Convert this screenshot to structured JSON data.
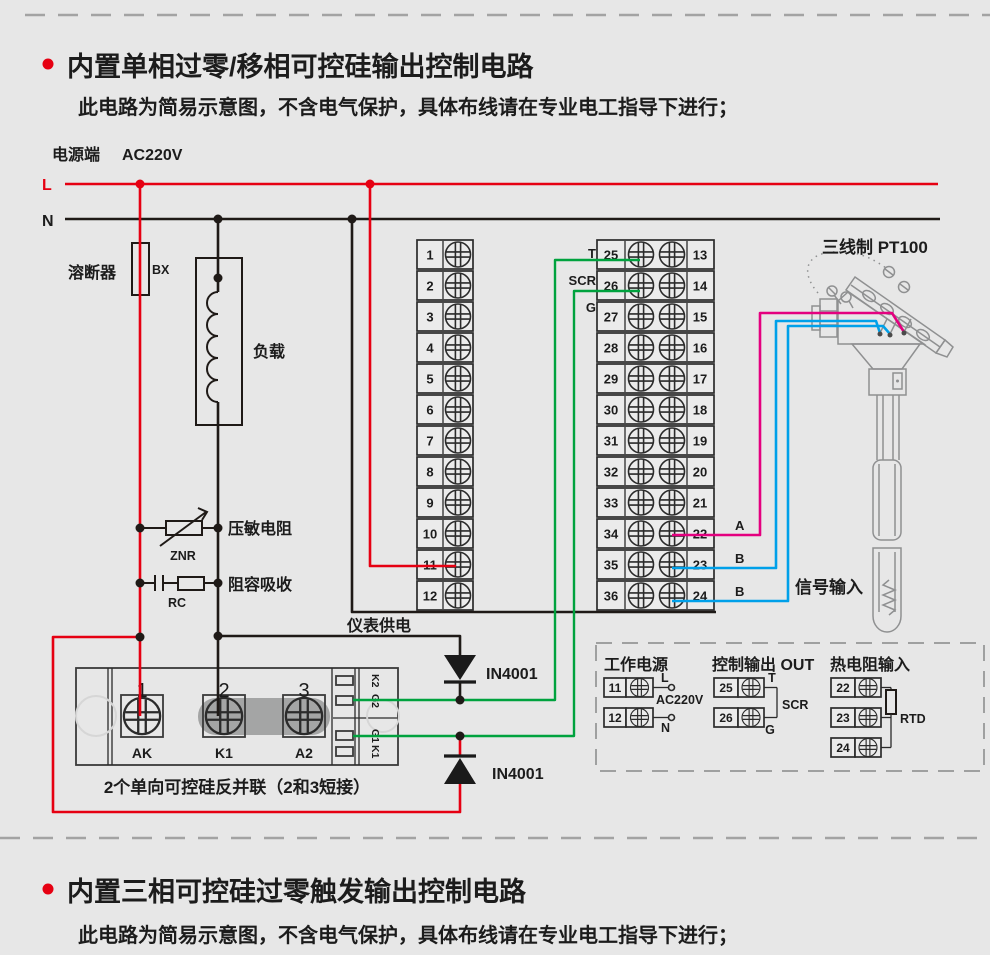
{
  "colors": {
    "red": "#e60012",
    "black": "#1f1a17",
    "green": "#00a23e",
    "magenta": "#e4007f",
    "blue": "#00a0e9",
    "gray": "#8f9091",
    "bg": "#e7e7e7"
  },
  "sections": {
    "one": {
      "title": "内置单相过零/移相可控硅输出控制电路",
      "subtitle": "此电路为简易示意图，不含电气保护，具体布线请在专业电工指导下进行；"
    },
    "two": {
      "title": "内置三相可控硅过零触发输出控制电路",
      "subtitle": "此电路为简易示意图，不含电气保护，具体布线请在专业电工指导下进行；"
    }
  },
  "power": {
    "label": "电源端",
    "voltage": "AC220V",
    "line_l": "L",
    "line_n": "N"
  },
  "components": {
    "fuse": "溶断器",
    "fuse_code": "BX",
    "load": "负载",
    "varistor": "压敏电阻",
    "varistor_code": "ZNR",
    "rc": "阻容吸收",
    "rc_code": "RC",
    "meter_supply": "仪表供电",
    "diode1": "IN4001",
    "diode2": "IN4001"
  },
  "output_labels": {
    "t": "T",
    "scr": "SCR",
    "g": "G"
  },
  "sensor": {
    "label": "三线制 PT100",
    "signal": "信号输入",
    "wire_a": "A",
    "wire_b1": "B",
    "wire_b2": "B"
  },
  "scr_module": {
    "n1": "1",
    "n2": "2",
    "n3": "3",
    "ak": "AK",
    "k1": "K1",
    "a2": "A2",
    "tabs": [
      "K2",
      "G2",
      "G1",
      "K1"
    ],
    "caption": "2个单向可控硅反并联（2和3短接）"
  },
  "terminal_strips": {
    "left": [
      "1",
      "2",
      "3",
      "4",
      "5",
      "6",
      "7",
      "8",
      "9",
      "10",
      "11",
      "12"
    ],
    "middle": [
      "25",
      "26",
      "27",
      "28",
      "29",
      "30",
      "31",
      "32",
      "33",
      "34",
      "35",
      "36"
    ],
    "right": [
      "13",
      "14",
      "15",
      "16",
      "17",
      "18",
      "19",
      "20",
      "21",
      "22",
      "23",
      "24"
    ]
  },
  "legend": {
    "power": {
      "title": "工作电源",
      "rows": [
        "11",
        "12"
      ],
      "l": "L",
      "voltage": "AC220V",
      "n": "N"
    },
    "output": {
      "title": "控制输出 OUT",
      "rows": [
        "25",
        "26"
      ],
      "t": "T",
      "scr": "SCR",
      "g": "G"
    },
    "rtd": {
      "title": "热电阻输入",
      "rows": [
        "22",
        "23",
        "24"
      ],
      "code": "RTD"
    }
  }
}
